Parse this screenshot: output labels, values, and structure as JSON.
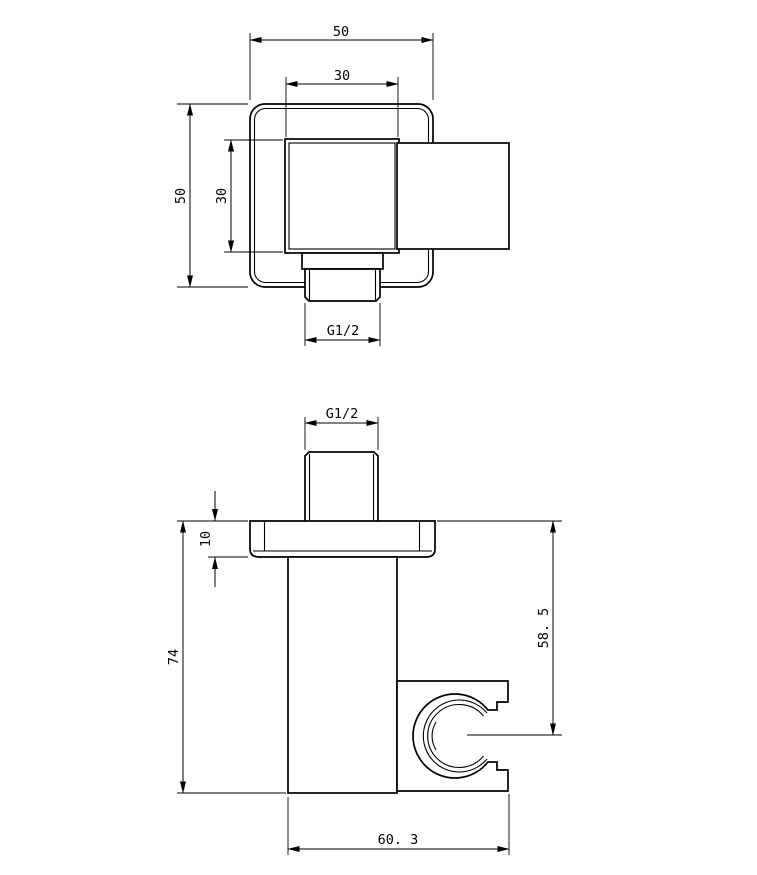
{
  "drawing": {
    "background": "#ffffff",
    "line_color": "#000000",
    "description": "two-view dimensioned technical drawing of shower outlet elbow with hand shower holder",
    "top_view": {
      "dims": {
        "overall_width": "50",
        "inner_width": "30",
        "overall_height": "50",
        "inner_height": "30",
        "thread": "G1/2"
      }
    },
    "front_view": {
      "dims": {
        "thread": "G1/2",
        "flange_thickness": "10",
        "overall_height": "74",
        "holder_center_drop": "58. 5",
        "overall_depth": "60. 3"
      }
    }
  }
}
